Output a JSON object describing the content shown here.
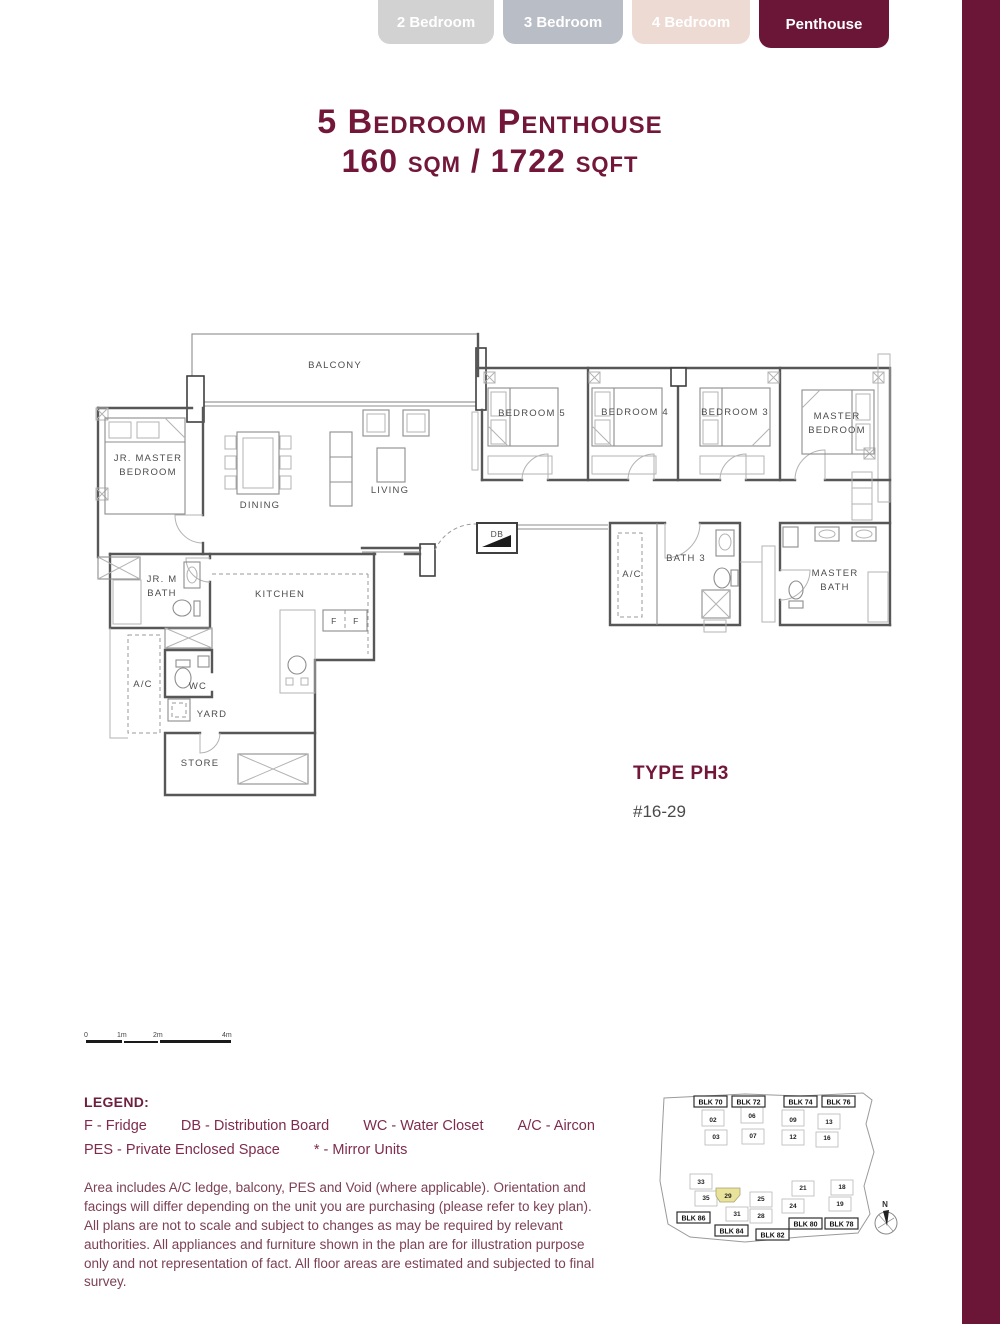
{
  "tabs": [
    {
      "label": "2 Bedroom",
      "active": false
    },
    {
      "label": "3 Bedroom",
      "active": false
    },
    {
      "label": "4 Bedroom",
      "active": false
    },
    {
      "label": "Penthouse",
      "active": true
    }
  ],
  "header": {
    "title_line1": "5 Bedroom Penthouse",
    "title_line2": "160 sqm / 1722 sqft"
  },
  "type_info": {
    "type_label": "TYPE PH3",
    "unit_label": "#16-29"
  },
  "floor_plan": {
    "labels": {
      "balcony": "BALCONY",
      "jr_master_line1": "JR. MASTER",
      "jr_master_line2": "BEDROOM",
      "dining": "DINING",
      "living": "LIVING",
      "bedroom5": "BEDROOM 5",
      "bedroom4": "BEDROOM 4",
      "bedroom3": "BEDROOM 3",
      "master_line1": "MASTER",
      "master_line2": "BEDROOM",
      "db": "DB",
      "ac_upper": "A/C",
      "bath3": "BATH 3",
      "master_bath_line1": "MASTER",
      "master_bath_line2": "BATH",
      "jr_bath_line1": "JR. M",
      "jr_bath_line2": "BATH",
      "kitchen": "KITCHEN",
      "fridge_left": "F",
      "fridge_right": "F",
      "ac_lower": "A/C",
      "wc": "WC",
      "yard": "YARD",
      "store": "STORE"
    }
  },
  "scale_bar": {
    "labels": [
      "0",
      "1m",
      "2m",
      "4m"
    ]
  },
  "legend": {
    "title": "LEGEND:",
    "row1": [
      "F - Fridge",
      "DB - Distribution Board",
      "WC - Water Closet",
      "A/C - Aircon"
    ],
    "row2": [
      "PES - Private Enclosed Space",
      "* - Mirror Units"
    ]
  },
  "disclaimer": "Area includes A/C ledge, balcony, PES and Void (where applicable). Orientation and facings will differ depending on the unit you are purchasing (please refer to key plan). All plans are not to scale and subject to changes as may be required by relevant authorities. All appliances and furniture shown in the plan are for illustration purpose only and not representation of fact. All floor areas are estimated and subjected to final survey.",
  "site_plan": {
    "blocks_top": [
      "BLK 70",
      "BLK 72",
      "BLK 74",
      "BLK 76"
    ],
    "blocks_bottom": [
      "BLK 86",
      "BLK 84",
      "BLK 82",
      "BLK 80",
      "BLK 78"
    ],
    "units_top": [
      "02",
      "06",
      "09",
      "13",
      "03",
      "07",
      "12",
      "16"
    ],
    "units_bottom": [
      "33",
      "35",
      "29",
      "25",
      "21",
      "18",
      "24",
      "19",
      "31",
      "28"
    ],
    "highlighted_unit": "29",
    "compass_label": "N"
  },
  "colors": {
    "accent": "#6C1637",
    "title": "#73173A",
    "tab_2br": "#D2D2D2",
    "tab_3br": "#B9BDC6",
    "tab_4br": "#ECDAD3",
    "highlight": "#E8E29B"
  }
}
